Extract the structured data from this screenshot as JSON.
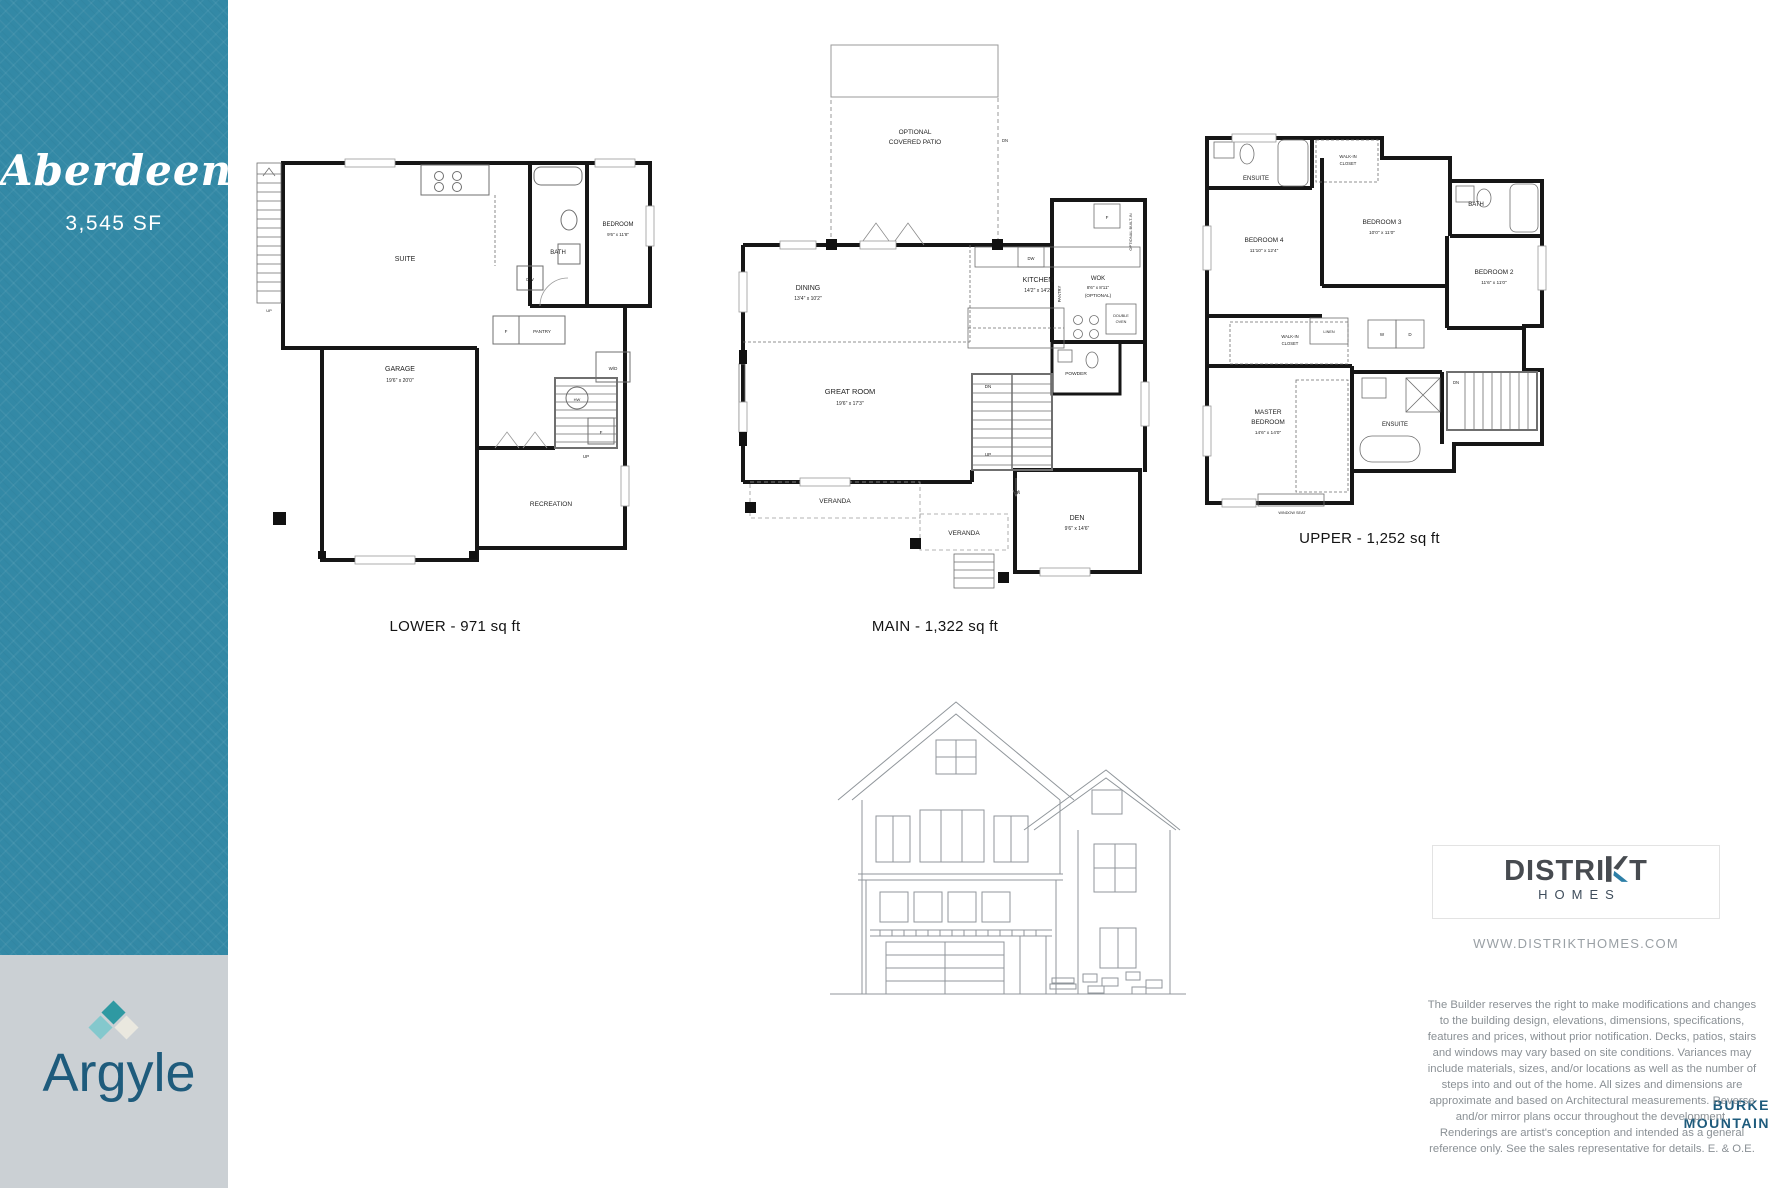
{
  "sidebar": {
    "plan_name": "Aberdeen",
    "plan_size": "3,545 SF"
  },
  "branding": {
    "argyle": {
      "name": "Argyle",
      "location_line1": "BURKE",
      "location_line2": "MOUNTAIN"
    },
    "distrikt": {
      "name_part1": "DISTRI",
      "name_part2": "T",
      "sub": "HOMES",
      "website": "WWW.DISTRIKTHOMES.COM"
    }
  },
  "colors": {
    "teal_sidebar": "#3389a6",
    "brand_gray": "#cbd0d4",
    "argyle_navy": "#1e5b7c",
    "diamond_teal": "#2f99a2",
    "diamond_light": "#84c8cd",
    "diamond_cream": "#eae8df",
    "distrikt_dark": "#474b50",
    "distrikt_blue": "#2d7fa7"
  },
  "disclaimer": "The Builder reserves the right to make modifications and changes to the building design, elevations, dimensions, specifications, features and prices, without prior notification. Decks, patios, stairs and windows may vary based on site conditions. Variances may include materials, sizes, and/or locations as well as the number of steps into and out of the home. All sizes and dimensions are approximate and based on Architectural measurements. Reverse and/or mirror plans occur throughout the development. Renderings are artist's conception and intended as a general reference only. See the sales representative for details. E. & O.E.",
  "plans": {
    "lower": {
      "caption": "LOWER - 971 sq ft",
      "labels": [
        {
          "t": "SUITE",
          "x": 150,
          "y": 115,
          "s": 7
        },
        {
          "t": "BATH",
          "x": 303,
          "y": 108,
          "s": 6
        },
        {
          "t": "BEDROOM",
          "x": 363,
          "y": 80,
          "s": 6
        },
        {
          "t": "9'6\" x 11'8\"",
          "x": 363,
          "y": 90,
          "s": 4.5,
          "c": "#444"
        },
        {
          "t": "GARAGE",
          "x": 145,
          "y": 225,
          "s": 7
        },
        {
          "t": "19'6\" x 20'0\"",
          "x": 145,
          "y": 236,
          "s": 5,
          "c": "#444"
        },
        {
          "t": "F",
          "x": 251,
          "y": 187,
          "s": 4.5
        },
        {
          "t": "PANTRY",
          "x": 287,
          "y": 187,
          "s": 4.5
        },
        {
          "t": "DW",
          "x": 275,
          "y": 135,
          "s": 4.5
        },
        {
          "t": "W/D",
          "x": 358,
          "y": 224,
          "s": 4.5
        },
        {
          "t": "HW",
          "x": 322,
          "y": 255,
          "s": 4
        },
        {
          "t": "F",
          "x": 346,
          "y": 288,
          "s": 4.5
        },
        {
          "t": "UP",
          "x": 331,
          "y": 312,
          "s": 4.5
        },
        {
          "t": "RECREATION",
          "x": 296,
          "y": 360,
          "s": 6.5
        },
        {
          "t": "UP",
          "x": 14,
          "y": 166,
          "s": 4
        }
      ]
    },
    "main": {
      "caption": "MAIN - 1,322 sq ft",
      "labels": [
        {
          "t": "OPTIONAL",
          "x": 195,
          "y": 92,
          "s": 6.5
        },
        {
          "t": "COVERED PATIO",
          "x": 195,
          "y": 102,
          "s": 6.5
        },
        {
          "t": "DN",
          "x": 285,
          "y": 100,
          "s": 4.2
        },
        {
          "t": "DINING",
          "x": 88,
          "y": 248,
          "s": 7
        },
        {
          "t": "13'4\" x 10'2\"",
          "x": 88,
          "y": 258,
          "s": 5,
          "c": "#444"
        },
        {
          "t": "KITCHEN",
          "x": 318,
          "y": 240,
          "s": 7
        },
        {
          "t": "14'2\" x 14'2\"",
          "x": 318,
          "y": 250,
          "s": 5,
          "c": "#444"
        },
        {
          "t": "DW",
          "x": 311,
          "y": 218,
          "s": 4.2
        },
        {
          "t": "F",
          "x": 387,
          "y": 177,
          "s": 4.5
        },
        {
          "t": "WOK",
          "x": 378,
          "y": 238,
          "s": 6
        },
        {
          "t": "8'6\" x 8'11\"",
          "x": 378,
          "y": 247,
          "s": 4.6,
          "c": "#444"
        },
        {
          "t": "(OPTIONAL)",
          "x": 378,
          "y": 255,
          "s": 4.6,
          "c": "#444"
        },
        {
          "t": "PANTRY",
          "x": 341,
          "y": 252,
          "s": 4.2,
          "v": true
        },
        {
          "t": "OPTIONAL BUILT-IN",
          "x": 412,
          "y": 190,
          "s": 4,
          "v": true
        },
        {
          "t": "DOUBLE",
          "x": 401,
          "y": 275,
          "s": 3.8
        },
        {
          "t": "OVEN",
          "x": 401,
          "y": 281,
          "s": 3.8
        },
        {
          "t": "POWDER",
          "x": 356,
          "y": 333,
          "s": 4.8
        },
        {
          "t": "GREAT ROOM",
          "x": 130,
          "y": 352,
          "s": 7.5
        },
        {
          "t": "19'6\" x 17'3\"",
          "x": 130,
          "y": 363,
          "s": 5,
          "c": "#444"
        },
        {
          "t": "DN",
          "x": 268,
          "y": 346,
          "s": 4.5
        },
        {
          "t": "UP",
          "x": 268,
          "y": 414,
          "s": 4.5
        },
        {
          "t": "DN",
          "x": 297,
          "y": 452,
          "s": 4.2
        },
        {
          "t": "DEN",
          "x": 357,
          "y": 478,
          "s": 7
        },
        {
          "t": "9'6\" x 14'6\"",
          "x": 357,
          "y": 488,
          "s": 5,
          "c": "#444"
        },
        {
          "t": "VERANDA",
          "x": 115,
          "y": 461,
          "s": 6.5
        },
        {
          "t": "VERANDA",
          "x": 244,
          "y": 493,
          "s": 6.5
        }
      ]
    },
    "upper": {
      "caption": "UPPER - 1,252 sq ft",
      "labels": [
        {
          "t": "ENSUITE",
          "x": 64,
          "y": 54,
          "s": 6
        },
        {
          "t": "WALK-IN",
          "x": 156,
          "y": 32,
          "s": 4.2
        },
        {
          "t": "CLOSET",
          "x": 156,
          "y": 39,
          "s": 4.2
        },
        {
          "t": "BEDROOM 4",
          "x": 72,
          "y": 116,
          "s": 6.5
        },
        {
          "t": "11'10\" x 12'4\"",
          "x": 72,
          "y": 126,
          "s": 4.8,
          "c": "#444"
        },
        {
          "t": "BEDROOM 3",
          "x": 190,
          "y": 98,
          "s": 6.5
        },
        {
          "t": "10'0\" x 11'0\"",
          "x": 190,
          "y": 108,
          "s": 4.8,
          "c": "#444"
        },
        {
          "t": "BATH",
          "x": 284,
          "y": 80,
          "s": 6
        },
        {
          "t": "BEDROOM 2",
          "x": 302,
          "y": 148,
          "s": 6.5
        },
        {
          "t": "11'6\" x 11'0\"",
          "x": 302,
          "y": 158,
          "s": 4.8,
          "c": "#444"
        },
        {
          "t": "LINEN",
          "x": 137,
          "y": 207,
          "s": 3.8
        },
        {
          "t": "W",
          "x": 190,
          "y": 210,
          "s": 4.5
        },
        {
          "t": "D",
          "x": 218,
          "y": 210,
          "s": 4.5
        },
        {
          "t": "WALK-IN",
          "x": 98,
          "y": 212,
          "s": 4.2
        },
        {
          "t": "CLOSET",
          "x": 98,
          "y": 219,
          "s": 4.2
        },
        {
          "t": "MASTER",
          "x": 76,
          "y": 288,
          "s": 6.5
        },
        {
          "t": "BEDROOM",
          "x": 76,
          "y": 298,
          "s": 6.5
        },
        {
          "t": "14'6\" x 14'0\"",
          "x": 76,
          "y": 308,
          "s": 4.8,
          "c": "#444"
        },
        {
          "t": "ENSUITE",
          "x": 203,
          "y": 300,
          "s": 6
        },
        {
          "t": "DN",
          "x": 264,
          "y": 258,
          "s": 4.2
        },
        {
          "t": "WINDOW SEAT",
          "x": 100,
          "y": 388,
          "s": 3.8
        }
      ]
    }
  }
}
